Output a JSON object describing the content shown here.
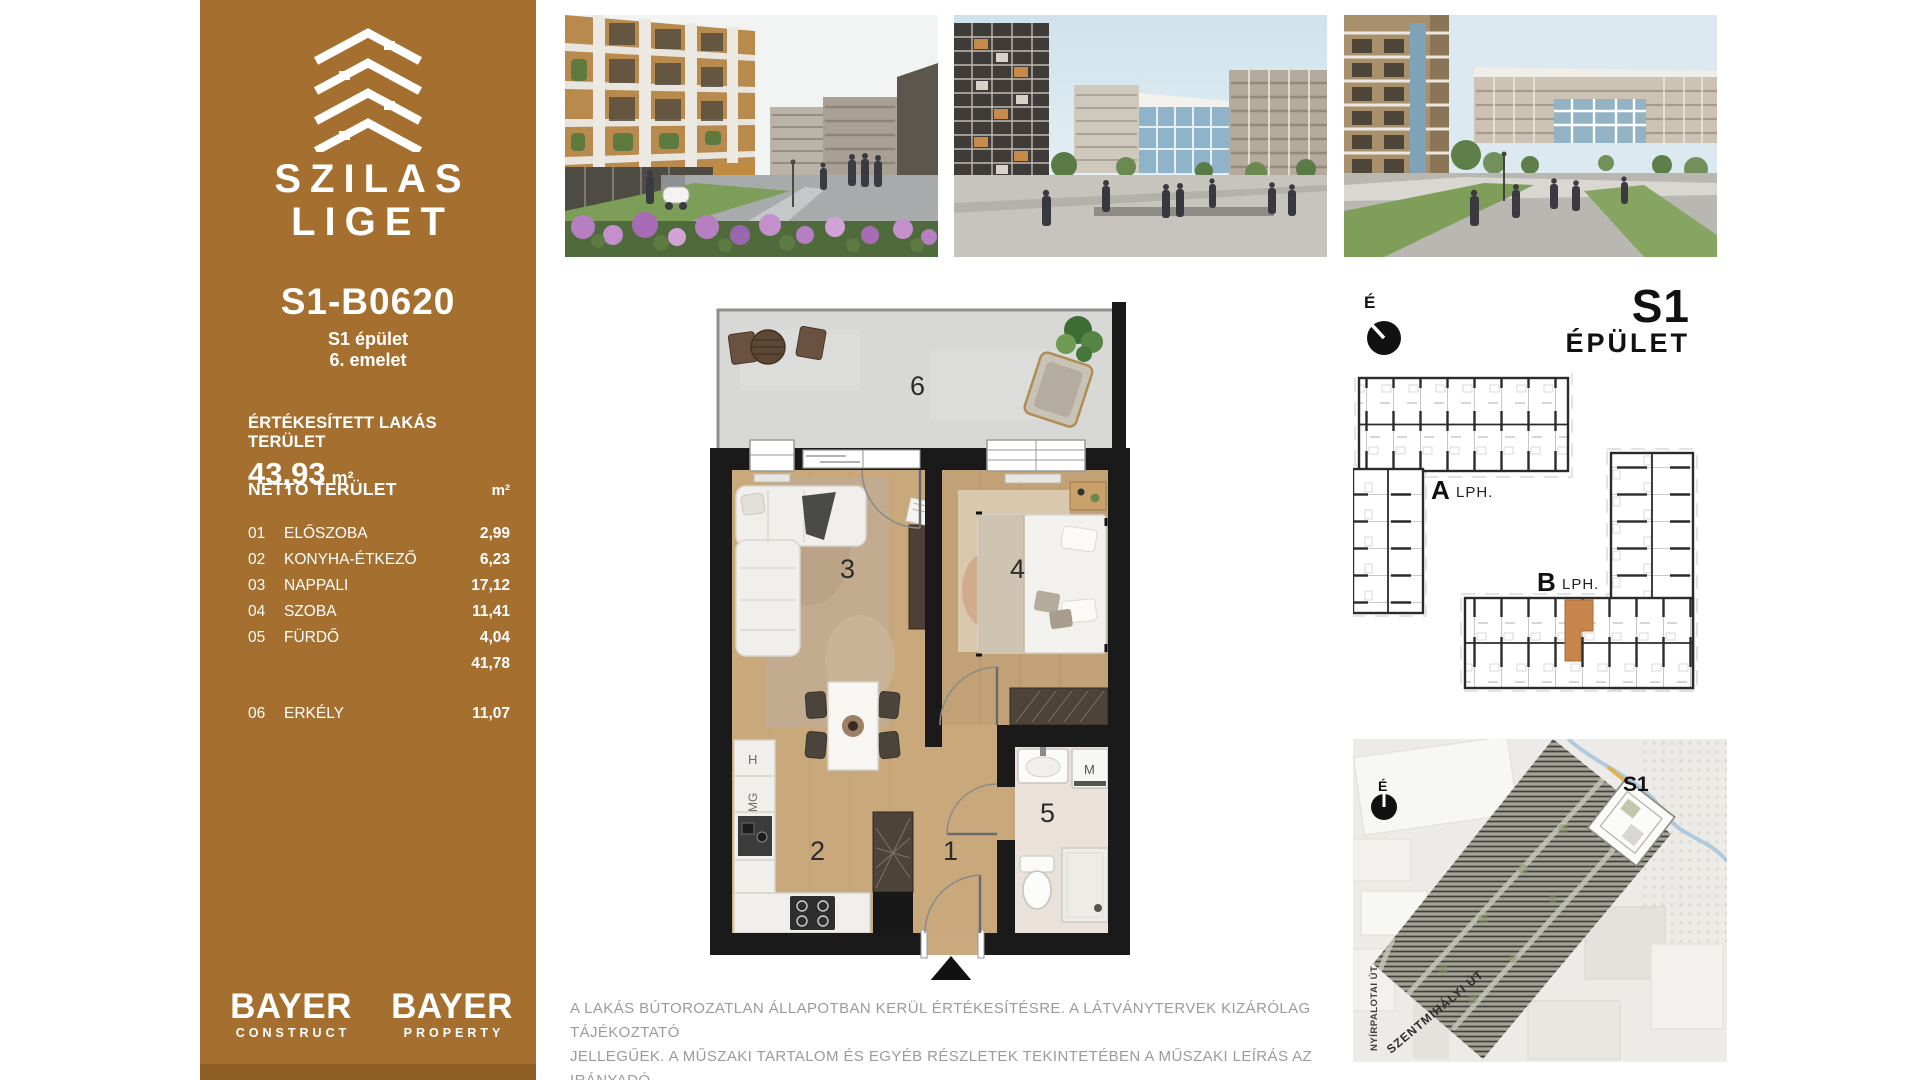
{
  "sidebar": {
    "bg": "#A5702F",
    "brand_line1": "SZILAS",
    "brand_line2": "LIGET",
    "unit_id": "S1-B0620",
    "building_line": "S1 épület",
    "floor_line": "6. emelet",
    "sold_label": "ÉRTÉKESÍTETT LAKÁS TERÜLET",
    "sold_value": "43,93",
    "sold_unit": "m²",
    "net_label": "NETTÓ TERÜLET",
    "net_unit": "m²",
    "rooms": [
      {
        "num": "01",
        "name": "ELŐSZOBA",
        "area": "2,99"
      },
      {
        "num": "02",
        "name": "KONYHA-ÉTKEZŐ",
        "area": "6,23"
      },
      {
        "num": "03",
        "name": "NAPPALI",
        "area": "17,12"
      },
      {
        "num": "04",
        "name": "SZOBA",
        "area": "11,41"
      },
      {
        "num": "05",
        "name": "FÜRDŐ",
        "area": "4,04"
      }
    ],
    "total_value": "41,78",
    "extra_room": {
      "num": "06",
      "name": "ERKÉLY",
      "area": "11,07"
    },
    "logo1_name": "BAYER",
    "logo1_sub": "CONSTRUCT",
    "logo2_name": "BAYER",
    "logo2_sub": "PROPERTY"
  },
  "floorplan": {
    "n1": "1",
    "n2": "2",
    "n3": "3",
    "n4": "4",
    "n5": "5",
    "n6": "6",
    "label_fridge": "H",
    "label_dishwasher": "MG",
    "label_washer": "M"
  },
  "building_header": {
    "name": "S1",
    "sub": "ÉPÜLET",
    "north": "É"
  },
  "building_plan": {
    "stair_a": "A",
    "stair_a_sub": "LPH.",
    "stair_b": "B",
    "stair_b_sub": "LPH.",
    "highlight": "#C8854B"
  },
  "site_map": {
    "north": "É",
    "building": "S1",
    "street1": "NYÍRPALOTAI ÚT",
    "street2": "SZENTMIHÁLYI ÚT"
  },
  "disclaimer_line1": "A LAKÁS BÚTOROZATLAN ÁLLAPOTBAN KERÜL ÉRTÉKESÍTÉSRE. A LÁTVÁNYTERVEK KIZÁRÓLAG TÁJÉKOZTATÓ",
  "disclaimer_line2": "JELLEGŰEK. A MŰSZAKI TARTALOM ÉS EGYÉB RÉSZLETEK TEKINTETÉBEN A MŰSZAKI LEÍRÁS AZ IRÁNYADÓ."
}
